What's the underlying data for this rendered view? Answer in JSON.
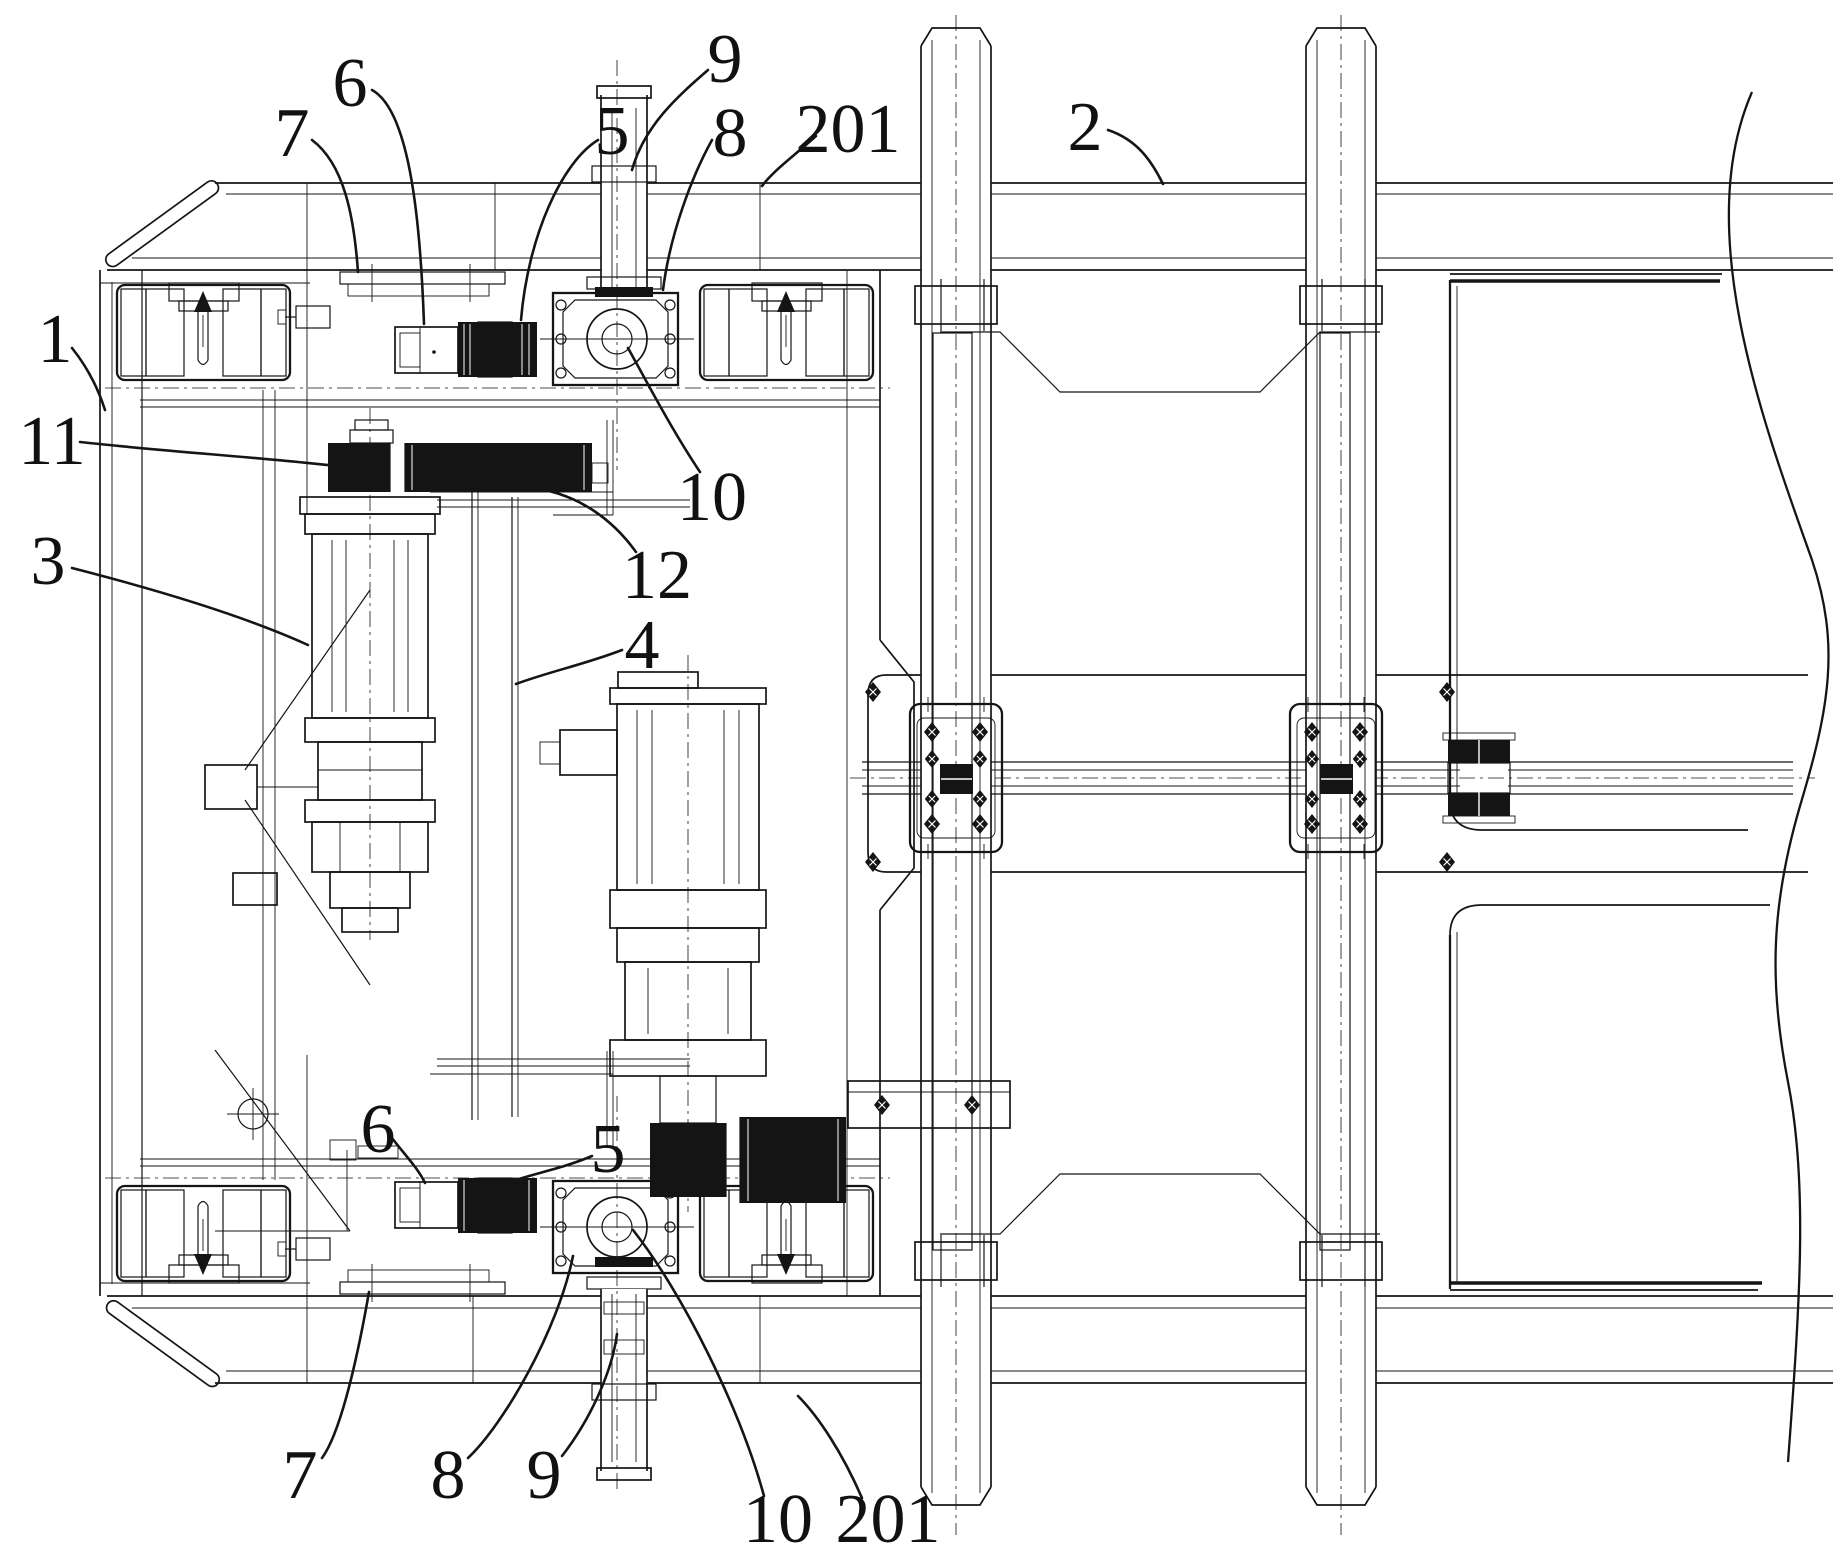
{
  "drawing": {
    "kind": "patent-mechanical-drawing",
    "paper_color": "#ffffff",
    "ink_color": "#151515",
    "callouts": [
      {
        "label": "1",
        "x": 55,
        "y": 338,
        "leader": "M72,348 C88,368 98,388 105,410"
      },
      {
        "label": "11",
        "x": 52,
        "y": 440,
        "leader": "M80,442 C170,452 272,458 354,468"
      },
      {
        "label": "3",
        "x": 48,
        "y": 560,
        "leader": "M72,568 C150,588 240,614 308,645"
      },
      {
        "label": "7",
        "x": 292,
        "y": 132,
        "leader": "M312,140 C344,164 354,216 358,272"
      },
      {
        "label": "6",
        "x": 350,
        "y": 82,
        "leader": "M372,90 C408,110 420,210 424,324"
      },
      {
        "label": "5",
        "x": 612,
        "y": 130,
        "leader": "M598,140 C562,162 528,236 521,320"
      },
      {
        "label": "9",
        "x": 725,
        "y": 58,
        "leader": "M708,70 C678,96 644,126 632,170"
      },
      {
        "label": "8",
        "x": 730,
        "y": 132,
        "leader": "M712,140 C692,176 670,234 663,290"
      },
      {
        "label": "201",
        "x": 848,
        "y": 128,
        "leader": "M816,136 C794,156 774,170 762,186"
      },
      {
        "label": "2",
        "x": 1085,
        "y": 126,
        "leader": "M1108,130 C1138,140 1152,162 1163,184"
      },
      {
        "label": "10",
        "x": 712,
        "y": 496,
        "leader": "M700,472 C672,430 648,384 628,348"
      },
      {
        "label": "12",
        "x": 657,
        "y": 574,
        "leader": "M636,552 C610,516 578,498 549,491"
      },
      {
        "label": "4",
        "x": 642,
        "y": 644,
        "leader": "M622,650 C586,664 548,672 516,684"
      },
      {
        "label": "6",
        "x": 378,
        "y": 1128,
        "leader": "M392,1138 C404,1154 418,1168 425,1183"
      },
      {
        "label": "5",
        "x": 608,
        "y": 1148,
        "leader": "M592,1156 C564,1168 532,1174 513,1181"
      },
      {
        "label": "7",
        "x": 300,
        "y": 1474,
        "leader": "M322,1458 C344,1428 362,1332 369,1292"
      },
      {
        "label": "8",
        "x": 448,
        "y": 1474,
        "leader": "M468,1458 C504,1424 558,1330 573,1256"
      },
      {
        "label": "9",
        "x": 544,
        "y": 1474,
        "leader": "M562,1456 C590,1420 612,1372 617,1334"
      },
      {
        "label": "10",
        "x": 778,
        "y": 1518,
        "leader": "M764,1496 C740,1408 682,1292 633,1230"
      },
      {
        "label": "201",
        "x": 888,
        "y": 1518,
        "leader": "M862,1498 C842,1452 818,1416 798,1396"
      }
    ]
  }
}
